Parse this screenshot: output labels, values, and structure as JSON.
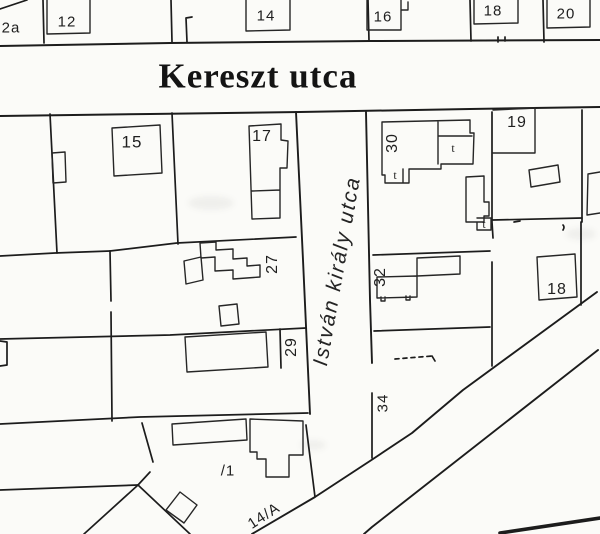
{
  "colors": {
    "ink": "#1e1e1e",
    "paper": "#fbfbf8"
  },
  "streets": {
    "horizontal": {
      "name": "Kereszt utca"
    },
    "vertical": {
      "name": "István király utca"
    }
  },
  "parcel_labels": {
    "p2a": "2a",
    "p12": "12",
    "p14": "14",
    "p16": "16",
    "p18_top": "18",
    "p20": "20",
    "p15": "15",
    "p17": "17",
    "p19": "19",
    "p30": "30",
    "p27": "27",
    "p32": "32",
    "p18_right": "18",
    "p29": "29",
    "p34": "34",
    "p1": "/1",
    "p14a": "14/A"
  },
  "symbols": {
    "cross_a": "t",
    "cross_b": "t",
    "cross_c": "t"
  }
}
